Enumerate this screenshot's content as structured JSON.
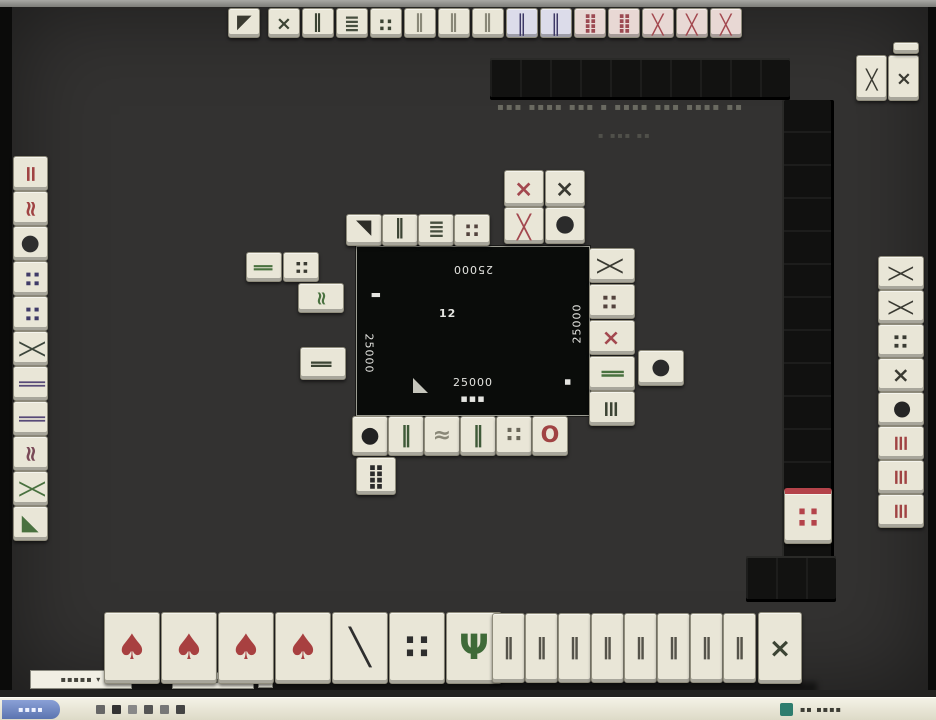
{
  "window": {
    "caption_line1": "▪▪▪ ▪▪▪▪ ▪▪▪ ▪ ▪▪▪▪ ▪▪▪ ▪▪▪▪ ▪▪",
    "caption_line2": "▪ ▪▪▪ ▪▪"
  },
  "center_panel": {
    "score_top": "25000",
    "score_left": "25000",
    "score_right": "25000",
    "score_bottom": "25000",
    "round_info": "12",
    "wind_left_glyph": "▮",
    "wind_right_glyph": "▪",
    "sub_text": "▪▪▪"
  },
  "controls": {
    "box1": "▪▪▪▪▪ ▾",
    "box2": "▪ ▪▪ ▪",
    "box3": ""
  },
  "taskbar": {
    "start_label": "▪▪▪▪",
    "clock": "▪▪ ▪▪▪▪"
  },
  "colors": {
    "table": "#333231",
    "tile_face": "#e9e6d7",
    "wall": "#121211",
    "taskbar": "#e3e0cf",
    "start_blue": "#6b82bd",
    "tray_teal": "#2e7d6e",
    "accent_red": "#c03c3c"
  },
  "tile_groups": [
    {
      "tile_name": "opponent-top-hand-tile",
      "interactable": false,
      "orient": "down",
      "dw": 32,
      "dh": 30,
      "tiles": [
        {
          "x": 216,
          "y": 1,
          "g": "◢",
          "c": "#3a3a30"
        },
        {
          "x": 256,
          "y": 1,
          "g": "×",
          "c": "#3c4434"
        },
        {
          "x": 290,
          "y": 1,
          "g": "‖",
          "c": "#3c4434"
        },
        {
          "x": 324,
          "y": 1,
          "g": "≣",
          "c": "#474f3f"
        },
        {
          "x": 358,
          "y": 1,
          "g": "∷",
          "c": "#3c4434"
        },
        {
          "x": 392,
          "y": 1,
          "g": "‖",
          "c": "#8a8878"
        },
        {
          "x": 426,
          "y": 1,
          "g": "‖",
          "c": "#8a8878"
        },
        {
          "x": 460,
          "y": 1,
          "g": "‖",
          "c": "#8a8878"
        },
        {
          "x": 494,
          "y": 1,
          "g": "║",
          "c": "#3d3866",
          "f": "#dcdcea"
        },
        {
          "x": 528,
          "y": 1,
          "g": "║",
          "c": "#3d3866",
          "f": "#dcdcea"
        },
        {
          "x": 562,
          "y": 1,
          "g": "⣿",
          "c": "#9c4a52",
          "f": "#e8d8d4"
        },
        {
          "x": 596,
          "y": 1,
          "g": "⣿",
          "c": "#9c4a52",
          "f": "#e8d8d4"
        },
        {
          "x": 630,
          "y": 1,
          "g": "╳",
          "c": "#a3484f",
          "f": "#e8d8d4"
        },
        {
          "x": 664,
          "y": 1,
          "g": "╳",
          "c": "#a3484f",
          "f": "#e8d8d4"
        },
        {
          "x": 698,
          "y": 1,
          "g": "╳",
          "c": "#a3484f",
          "f": "#e8d8d4"
        }
      ]
    },
    {
      "tile_name": "top-right-meld-tile",
      "interactable": false,
      "orient": "down",
      "dw": 31,
      "dh": 46,
      "tiles": [
        {
          "x": 844,
          "y": 48,
          "g": "╳",
          "c": "#3a3a32"
        },
        {
          "x": 876,
          "y": 48,
          "g": "×",
          "c": "#3a3a32"
        },
        {
          "x": 881,
          "y": 35,
          "w": 26,
          "h": 12,
          "g": "",
          "c": "#3a3a32"
        }
      ]
    },
    {
      "tile_name": "left-hand-tile",
      "interactable": false,
      "orient": "right",
      "dw": 35,
      "dh": 35,
      "tiles": [
        {
          "x": 1,
          "y": 149,
          "g": "=",
          "c": "#a04343"
        },
        {
          "x": 1,
          "y": 184,
          "g": "≈",
          "c": "#a04343"
        },
        {
          "x": 1,
          "y": 219,
          "g": "●",
          "c": "#2e2e2e"
        },
        {
          "x": 1,
          "y": 254,
          "g": "∷",
          "c": "#3f3a68"
        },
        {
          "x": 1,
          "y": 289,
          "g": "∷",
          "c": "#3f3a68"
        },
        {
          "x": 1,
          "y": 324,
          "g": "╳",
          "c": "#3c463c"
        },
        {
          "x": 1,
          "y": 359,
          "g": "║",
          "c": "#574a78"
        },
        {
          "x": 1,
          "y": 394,
          "g": "║",
          "c": "#574a78"
        },
        {
          "x": 1,
          "y": 429,
          "g": "≈",
          "c": "#7a4a58"
        },
        {
          "x": 1,
          "y": 464,
          "g": "╳",
          "c": "#49713f"
        },
        {
          "x": 1,
          "y": 499,
          "g": "◢",
          "c": "#49713f"
        }
      ]
    },
    {
      "tile_name": "right-hand-tile",
      "interactable": false,
      "orient": "left",
      "dw": 46,
      "dh": 34,
      "tiles": [
        {
          "x": 866,
          "y": 249,
          "g": "╳",
          "c": "#3a3a32"
        },
        {
          "x": 866,
          "y": 283,
          "g": "╳",
          "c": "#3a3a32"
        },
        {
          "x": 866,
          "y": 317,
          "g": "∷",
          "c": "#3a3a32"
        },
        {
          "x": 866,
          "y": 351,
          "g": "×",
          "c": "#3a3a32"
        },
        {
          "x": 866,
          "y": 385,
          "g": "●",
          "c": "#262626"
        },
        {
          "x": 866,
          "y": 419,
          "g": "≡",
          "c": "#a04343"
        },
        {
          "x": 866,
          "y": 453,
          "g": "≡",
          "c": "#a04343"
        },
        {
          "x": 866,
          "y": 487,
          "g": "≡",
          "c": "#a04343"
        }
      ]
    },
    {
      "tile_name": "discard-tile-top",
      "interactable": false,
      "orient": "down",
      "dw": 36,
      "dh": 32,
      "tiles": [
        {
          "x": 334,
          "y": 207,
          "g": "◣",
          "c": "#2e2e28"
        },
        {
          "x": 370,
          "y": 207,
          "g": "‖",
          "c": "#3c4434"
        },
        {
          "x": 406,
          "y": 207,
          "g": "≣",
          "c": "#474f3f"
        },
        {
          "x": 442,
          "y": 207,
          "g": "∷",
          "c": "#53433d"
        },
        {
          "x": 492,
          "y": 163,
          "w": 40,
          "h": 37,
          "g": "×",
          "c": "#a3484f"
        },
        {
          "x": 492,
          "y": 200,
          "w": 40,
          "h": 37,
          "g": "╳",
          "c": "#a3484f"
        },
        {
          "x": 533,
          "y": 163,
          "w": 40,
          "h": 37,
          "g": "×",
          "c": "#3a3a32"
        },
        {
          "x": 533,
          "y": 200,
          "w": 40,
          "h": 37,
          "g": "●",
          "c": "#2b2b2b"
        }
      ]
    },
    {
      "tile_name": "discard-tile-left",
      "interactable": false,
      "orient": "right",
      "dw": 36,
      "dh": 30,
      "tiles": [
        {
          "x": 234,
          "y": 245,
          "g": "‖",
          "c": "#49713f"
        },
        {
          "x": 271,
          "y": 245,
          "g": "∷",
          "c": "#3a3a32"
        },
        {
          "x": 286,
          "y": 276,
          "w": 46,
          "g": "≈",
          "c": "#49713f"
        },
        {
          "x": 288,
          "y": 340,
          "w": 46,
          "h": 33,
          "g": "‖",
          "c": "#3c4434"
        }
      ]
    },
    {
      "tile_name": "discard-tile-right",
      "interactable": false,
      "orient": "left",
      "dw": 46,
      "dh": 35,
      "tiles": [
        {
          "x": 577,
          "y": 241,
          "g": "╳",
          "c": "#3a3a32"
        },
        {
          "x": 577,
          "y": 277,
          "g": "∷",
          "c": "#53433d"
        },
        {
          "x": 577,
          "y": 313,
          "g": "×",
          "c": "#a3484f"
        },
        {
          "x": 577,
          "y": 349,
          "g": "‖",
          "c": "#49713f"
        },
        {
          "x": 577,
          "y": 384,
          "g": "≡",
          "c": "#3c4434"
        },
        {
          "x": 626,
          "y": 343,
          "h": 36,
          "g": "●",
          "c": "#2b2b2b"
        }
      ]
    },
    {
      "tile_name": "discard-tile-bottom",
      "interactable": false,
      "orient": "up",
      "dw": 36,
      "dh": 40,
      "tiles": [
        {
          "x": 340,
          "y": 409,
          "g": "●",
          "c": "#222222"
        },
        {
          "x": 376,
          "y": 409,
          "g": "‖",
          "c": "#3f5a38"
        },
        {
          "x": 412,
          "y": 409,
          "g": "≈",
          "c": "#8a8878"
        },
        {
          "x": 448,
          "y": 409,
          "g": "‖",
          "c": "#3f5a38"
        },
        {
          "x": 484,
          "y": 409,
          "g": "∷",
          "c": "#6a675a"
        },
        {
          "x": 520,
          "y": 409,
          "g": "O",
          "c": "#a04343"
        },
        {
          "x": 344,
          "y": 450,
          "w": 40,
          "h": 38,
          "g": "⣿",
          "c": "#2b2b2b"
        }
      ]
    },
    {
      "tile_name": "dora-indicator-tile",
      "interactable": false,
      "orient": "up",
      "dw": 48,
      "dh": 56,
      "tiles": [
        {
          "x": 772,
          "y": 481,
          "g": "∷",
          "c": "#b4434a",
          "stripe": "#b4434a"
        }
      ]
    },
    {
      "tile_name": "player-hand-tile",
      "interactable": true,
      "orient": "up",
      "dw": 56,
      "dh": 72,
      "tiles": [
        {
          "x": 92,
          "y": 605,
          "g": "♠",
          "c": "#a84040"
        },
        {
          "x": 149,
          "y": 605,
          "g": "♠",
          "c": "#a84040"
        },
        {
          "x": 206,
          "y": 605,
          "g": "♠",
          "c": "#a84040"
        },
        {
          "x": 263,
          "y": 605,
          "g": "♠",
          "c": "#a84040"
        },
        {
          "x": 320,
          "y": 605,
          "g": "╲",
          "c": "#2e2e2e"
        },
        {
          "x": 377,
          "y": 605,
          "g": "∷",
          "c": "#2e2e2e"
        },
        {
          "x": 434,
          "y": 605,
          "g": "Ψ",
          "c": "#3f6a38"
        }
      ]
    },
    {
      "tile_name": "player-hand-tile-right",
      "interactable": true,
      "orient": "up",
      "dw": 33,
      "dh": 70,
      "tiles": [
        {
          "x": 480,
          "y": 606,
          "g": "‖",
          "c": "#55534a",
          "fs": 22
        },
        {
          "x": 513,
          "y": 606,
          "g": "‖",
          "c": "#55534a",
          "fs": 22
        },
        {
          "x": 546,
          "y": 606,
          "g": "‖",
          "c": "#55534a",
          "fs": 22
        },
        {
          "x": 579,
          "y": 606,
          "g": "‖",
          "c": "#55534a",
          "fs": 22
        },
        {
          "x": 612,
          "y": 606,
          "g": "‖",
          "c": "#55534a",
          "fs": 22
        },
        {
          "x": 645,
          "y": 606,
          "g": "‖",
          "c": "#55534a",
          "fs": 22
        },
        {
          "x": 678,
          "y": 606,
          "g": "‖",
          "c": "#55534a",
          "fs": 22
        },
        {
          "x": 711,
          "y": 606,
          "g": "‖",
          "c": "#55534a",
          "fs": 22
        },
        {
          "x": 746,
          "y": 605,
          "w": 44,
          "h": 72,
          "g": "×",
          "c": "#3c4434"
        }
      ]
    }
  ]
}
